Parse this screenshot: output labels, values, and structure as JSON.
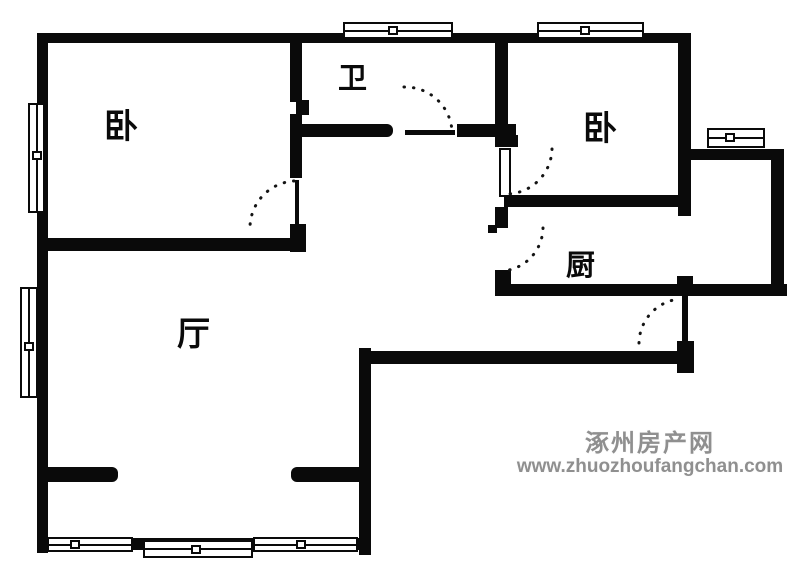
{
  "rooms": {
    "bedroom_left": {
      "label": "卧"
    },
    "bathroom": {
      "label": "卫"
    },
    "bedroom_right": {
      "label": "卧"
    },
    "kitchen": {
      "label": "厨"
    },
    "living": {
      "label": "厅"
    }
  },
  "watermark": {
    "site_name": "涿州房产网",
    "site_url": "www.zhuozhoufangchan.com"
  },
  "colors": {
    "wall": "#0a0a0a",
    "background": "#ffffff",
    "watermark_gray": "#8f8f8f"
  }
}
